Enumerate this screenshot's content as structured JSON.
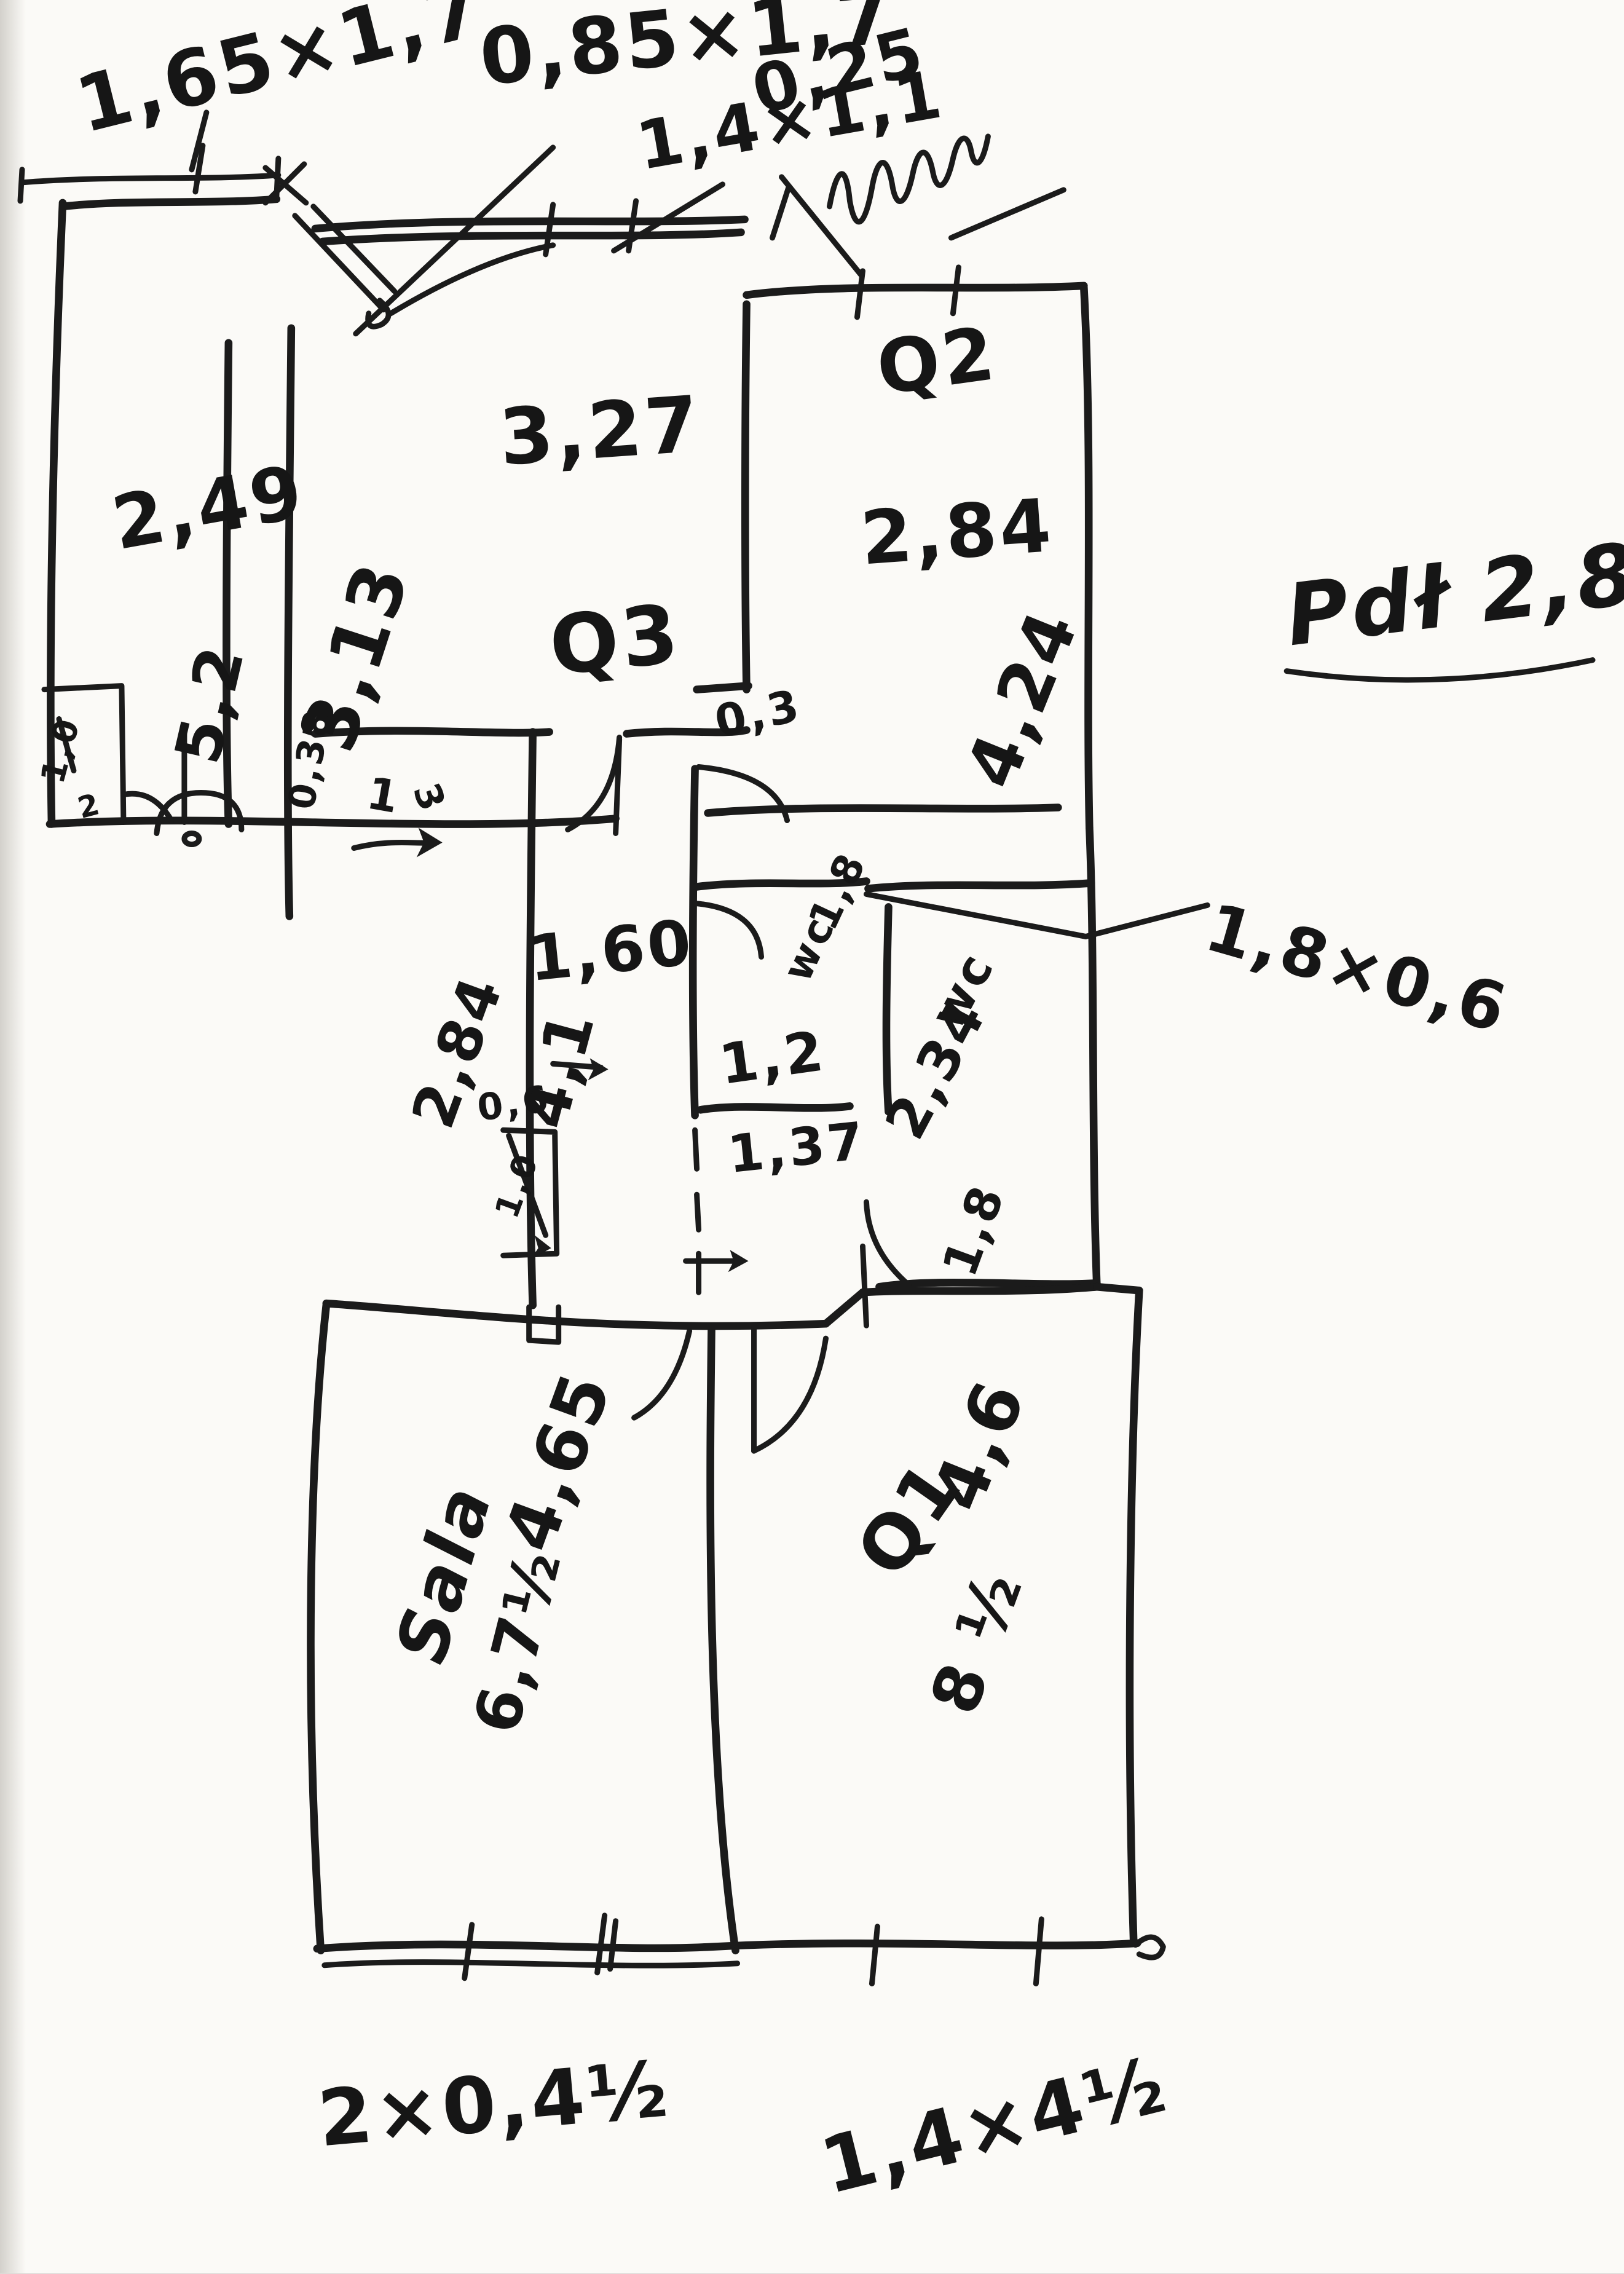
{
  "paper": {
    "background": "#fbfaf7",
    "ink": "#1b1b1b"
  },
  "labels": {
    "win_left": "1,65×1,7",
    "door_top": "0,85×1,7",
    "win_mid": "1,4×1,1",
    "dim_025": "0,25",
    "r1_width": "2,49",
    "r1_len": "5,2",
    "q3_side": "3,13",
    "q3_width": "3,27",
    "q3_name": "Q3",
    "q2_name": "Q2",
    "q2_width": "2,84",
    "q2_len": "4,24",
    "height_note": "Pdł 2,8",
    "dim_03": "0,3",
    "hall_width": "1,60",
    "hall_len": "4,1",
    "hall_side": "2,84",
    "wall_038": "0,38",
    "door_1": "1",
    "door_3": "3",
    "wc1_dim": "1,8",
    "wc1_name": "wc",
    "wc1_width": "1,2",
    "dim_137": "1,37",
    "wc2_name": "wc",
    "wc2_len": "2,34",
    "wc2_width": "1,8",
    "dim_18x06": "1,8×0,6",
    "shelf_06": "0,6",
    "shelf_10": "1,0",
    "closet_10": "1,0",
    "closet_2": "2",
    "sala_name": "Sala",
    "sala_len": "4,65",
    "sala_area": "6,7½",
    "q1_len": "4,6",
    "q1_name": "Q1",
    "q1_area": "8 ½",
    "bottom_left_dim": "2×0,4½",
    "bottom_mid_dim": "1,4×4½"
  }
}
